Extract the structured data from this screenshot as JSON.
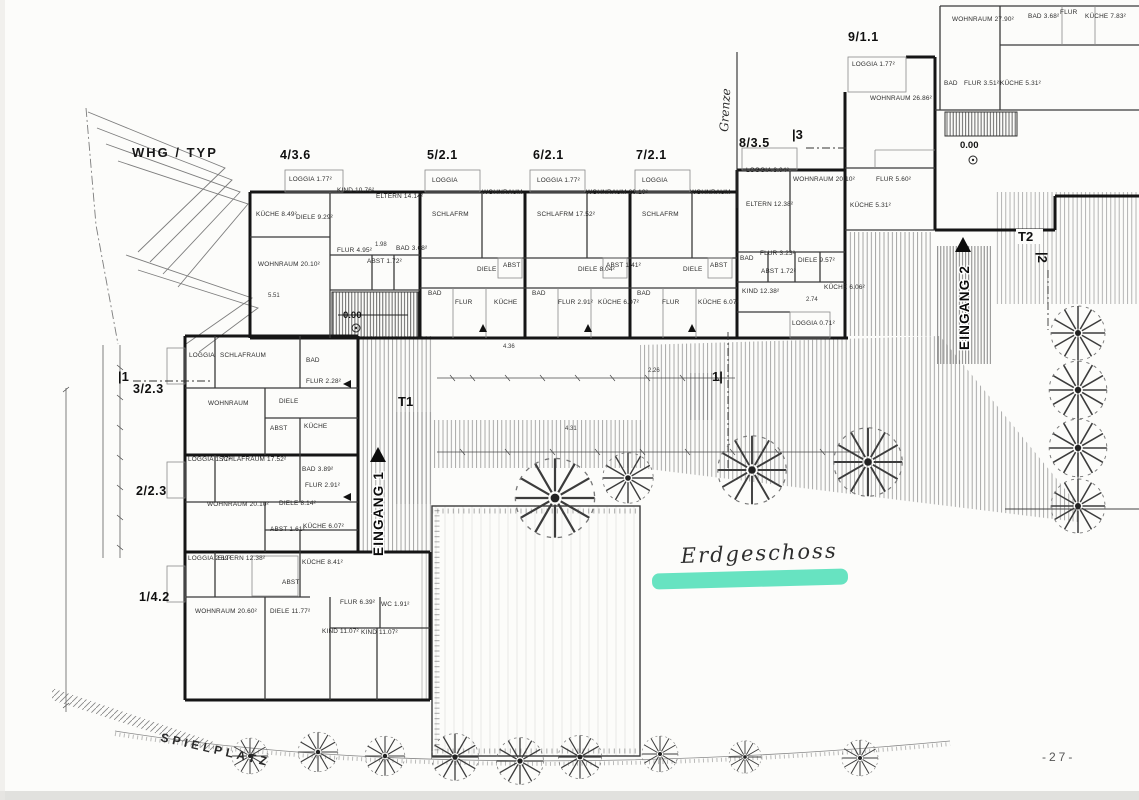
{
  "meta": {
    "whg_typ": "WHG / TYP",
    "floor_label": "Erdgeschoss",
    "page_number": "-27-",
    "spielplatz": "SPIELPLATZ",
    "grenze": "Grenze",
    "level": "0.00",
    "t1": "T1",
    "t2": "T2",
    "marker_1": "|1",
    "marker_1b": "1|",
    "marker_2": "|2",
    "marker_3": "|3",
    "highlight_color": "#57e0ba"
  },
  "entrances": {
    "e1": "EINGANG 1",
    "e2": "EINGANG 2"
  },
  "apartments": [
    {
      "label": "4/3.6",
      "rooms": [
        "LOGGIA 1.77²",
        "KIND 10.76²",
        "ELTERN 14.14²",
        "KÜCHE 8.49²",
        "DIELE 9.29²",
        "WOHNRAUM 20.10²",
        "FLUR 4.95²",
        "ABST 1.72²",
        "BAD 3.68²"
      ]
    },
    {
      "label": "5/2.1",
      "rooms": [
        "LOGGIA",
        "SCHLAFRM",
        "WOHNRAUM",
        "DIELE",
        "ABST",
        "BAD",
        "FLUR",
        "KÜCHE"
      ]
    },
    {
      "label": "6/2.1",
      "rooms": [
        "LOGGIA 1.77²",
        "SCHLAFRM 17.52²",
        "WOHNRAUM 20.10²",
        "DIELE 8.04²",
        "ABST 1.41²",
        "BAD",
        "FLUR 2.91²",
        "KÜCHE 6.07²"
      ]
    },
    {
      "label": "7/2.1",
      "rooms": [
        "LOGGIA",
        "SCHLAFRM",
        "WOHNRAUM",
        "DIELE",
        "ABST",
        "BAD",
        "FLUR",
        "KÜCHE 6.07²"
      ]
    },
    {
      "label": "8/3.5",
      "rooms": [
        "LOGGIA 3.04²",
        "ELTERN 12.38²",
        "WOHNRAUM 20.10²",
        "BAD",
        "FLUR 3.23²",
        "DIELE 9.57²",
        "ABST 1.72²",
        "KIND 12.38²",
        "KÜCHE 6.06²",
        "LOGGIA 0.71²"
      ]
    },
    {
      "label": "9/1.1",
      "rooms": [
        "LOGGIA 1.77²",
        "WOHNRAUM 26.86²",
        "FLUR 5.60²",
        "KÜCHE 5.31²"
      ]
    },
    {
      "label": "",
      "rooms": [
        "WOHNRAUM 27.90²",
        "BAD 3.68²",
        "FLUR",
        "KÜCHE 7.83²",
        "BAD",
        "FLUR 3.51²",
        "KÜCHE 5.31²"
      ]
    },
    {
      "label": "3/2.3",
      "rooms": [
        "LOGGIA",
        "SCHLAFRAUM",
        "WOHNRAUM",
        "DIELE",
        "ABST",
        "KÜCHE",
        "BAD",
        "FLUR 2.28²"
      ]
    },
    {
      "label": "2/2.3",
      "rooms": [
        "LOGGIA 1.77²",
        "SCHLAFRAUM 17.52²",
        "WOHNRAUM 20.10²",
        "DIELE 8.14²",
        "ABST 1.61²",
        "KÜCHE 6.07²",
        "BAD 3.89²",
        "FLUR 2.91²"
      ]
    },
    {
      "label": "1/4.2",
      "rooms": [
        "LOGGIA 2.69²",
        "ELTERN 12.38²",
        "WOHNRAUM 20.60²",
        "DIELE 11.77²",
        "KÜCHE 8.41²",
        "FLUR 6.39²",
        "KIND 11.07²",
        "KIND 11.07²",
        "ABST",
        "WC 1.91²"
      ]
    }
  ],
  "dims": [
    "5.51",
    "1.98",
    "4.36",
    "2.26",
    "2.74",
    "4.31"
  ]
}
